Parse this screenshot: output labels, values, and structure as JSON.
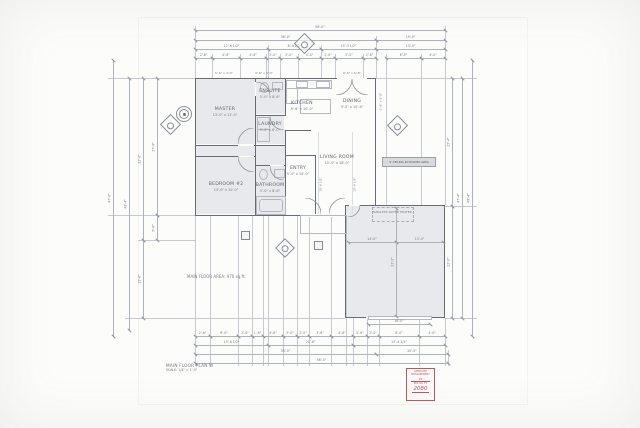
{
  "sheet": {
    "title_block": {
      "title": "MAIN FLOOR PLAN W",
      "scale": "SCALE: 1/4\" = 1'-0\""
    },
    "area_note": "MAIN FLOOR AREA: 970 sq.ft.",
    "ceiling_note": "9' CEILING IN SHADED AREA",
    "stamp": {
      "line1": "APPROVED MEASUREMENT",
      "line2": "26",
      "line3": "SEA SQ. FT.",
      "value": "2080",
      "color": "#b65a5e"
    },
    "paper_color": "#fcfcfb",
    "wall_color": "#666c76",
    "shade_color": "#e8e9ec"
  },
  "rooms": [
    {
      "label": "MASTER",
      "size": "13'-0\" x 12'-0\"",
      "x": 225,
      "y": 112
    },
    {
      "label": "ENSUITE",
      "size": "5'-0\" x 8'-6\"",
      "x": 270,
      "y": 94
    },
    {
      "label": "LAUNDRY",
      "size": "5'-0\" x 6'-0\"",
      "x": 270,
      "y": 127
    },
    {
      "label": "KITCHEN",
      "size": "9'-6\" x 10'-0\"",
      "x": 302,
      "y": 106
    },
    {
      "label": "DINING",
      "size": "9'-0\" x 10'-6\"",
      "x": 352,
      "y": 104
    },
    {
      "label": "LIVING ROOM",
      "size": "15'-0\" x 18'-0\"",
      "x": 337,
      "y": 160
    },
    {
      "label": "BEDROOM #2",
      "size": "13'-0\" x 10'-0\"",
      "x": 226,
      "y": 187
    },
    {
      "label": "BATHROOM",
      "size": "5'-0\" x 8'-6\"",
      "x": 270,
      "y": 188
    },
    {
      "label": "ENTRY",
      "size": "5'-0\" x 14'-0\"",
      "x": 298,
      "y": 171
    }
  ],
  "annotations": [
    {
      "text": "5'-6\" x 4'-0\"",
      "x": 224,
      "y": 72
    },
    {
      "text": "4'-6\" x 4'-0\"",
      "x": 264,
      "y": 72
    },
    {
      "text": "9'-0\" x 6'-8\"",
      "x": 352,
      "y": 72
    },
    {
      "text": "2'-8\" x 6'-8\"",
      "x": 381,
      "y": 100,
      "rot": -90
    },
    {
      "text": "10'-6 1/2\"",
      "x": 321,
      "y": 183,
      "rot": -90
    },
    {
      "text": "10'-6 1/2\"",
      "x": 355,
      "y": 183,
      "rot": -90
    },
    {
      "text": "TANKLESS WATER HEATER",
      "x": 392,
      "y": 211
    }
  ],
  "dimensions": {
    "horizontal": [
      {
        "y": 30,
        "segs": [
          [
            195,
            445,
            "56'-0\""
          ]
        ]
      },
      {
        "y": 40,
        "segs": [
          [
            195,
            376,
            "36'-0\""
          ],
          [
            376,
            445,
            "19'-0\""
          ]
        ]
      },
      {
        "y": 49,
        "segs": [
          [
            195,
            268,
            "12'-6 1/2\""
          ],
          [
            268,
            321,
            "8'-9 1/2\""
          ],
          [
            321,
            376,
            "15'-3 1/2\""
          ],
          [
            376,
            445,
            "13'-0\""
          ]
        ]
      },
      {
        "y": 58,
        "segs": [
          [
            195,
            212,
            "2'-6\""
          ],
          [
            212,
            240,
            "4'-6\""
          ],
          [
            240,
            266,
            "4'-6\""
          ],
          [
            266,
            280,
            "2'-0\""
          ],
          [
            280,
            298,
            "3'-0\""
          ],
          [
            298,
            321,
            "4'-0\""
          ],
          [
            321,
            335,
            "2'-0\""
          ],
          [
            335,
            363,
            "5'-0\""
          ],
          [
            363,
            376,
            "2'-6\""
          ],
          [
            386,
            421,
            "6'-0\""
          ],
          [
            421,
            445,
            "4'-0\""
          ]
        ]
      },
      {
        "y": 242,
        "segs": [
          [
            348,
            396,
            "14'-0\""
          ],
          [
            396,
            443,
            "13'-0\""
          ]
        ]
      },
      {
        "y": 324,
        "segs": [
          [
            368,
            430,
            "16'-0\""
          ]
        ]
      },
      {
        "y": 336,
        "segs": [
          [
            195,
            210,
            "2'-6\""
          ],
          [
            210,
            238,
            "6'-0\""
          ],
          [
            238,
            252,
            "2'-6\""
          ],
          [
            252,
            263,
            "1'-6\""
          ],
          [
            263,
            283,
            "4'-6\""
          ],
          [
            283,
            297,
            "3'-0\""
          ],
          [
            297,
            309,
            "2'-0\""
          ],
          [
            309,
            331,
            "3'-6\""
          ],
          [
            331,
            353,
            "4'-6\""
          ],
          [
            353,
            367,
            "2'-6\""
          ],
          [
            367,
            379,
            "2'-0\""
          ],
          [
            379,
            419,
            "8'-0\""
          ],
          [
            419,
            445,
            "4'-0\""
          ]
        ]
      },
      {
        "y": 345,
        "segs": [
          [
            195,
            268,
            "13'-6 1/2\""
          ],
          [
            268,
            353,
            "21'-6\""
          ],
          [
            353,
            445,
            "13'-4 1/2\""
          ]
        ]
      },
      {
        "y": 354,
        "segs": [
          [
            195,
            376,
            "36'-0\""
          ],
          [
            376,
            448,
            "20'-0\""
          ]
        ]
      },
      {
        "y": 363,
        "segs": [
          [
            195,
            448,
            "56'-0\""
          ]
        ]
      }
    ],
    "vertical": [
      {
        "x": 157,
        "segs": [
          [
            78,
            215,
            "27'-0\""
          ],
          [
            215,
            240,
            "5'-0\""
          ]
        ]
      },
      {
        "x": 143,
        "segs": [
          [
            78,
            240,
            "32'-0\""
          ],
          [
            240,
            318,
            "15'-6\""
          ]
        ]
      },
      {
        "x": 129,
        "segs": [
          [
            78,
            330,
            "43'-4\""
          ]
        ]
      },
      {
        "x": 113,
        "segs": [
          [
            60,
            336,
            "47'-0\""
          ]
        ]
      },
      {
        "x": 452,
        "segs": [
          [
            78,
            206,
            "25'-4\""
          ],
          [
            206,
            318,
            "22'-0\""
          ]
        ]
      },
      {
        "x": 462,
        "segs": [
          [
            78,
            318,
            "47'-4\""
          ]
        ]
      },
      {
        "x": 472,
        "segs": [
          [
            60,
            336,
            "49'-4\""
          ]
        ]
      },
      {
        "x": 396,
        "segs": [
          [
            208,
            316,
            "21'-2\""
          ]
        ]
      }
    ]
  },
  "geometry": {
    "shades": [
      [
        196,
        79,
        59,
        65
      ],
      [
        196,
        157,
        59,
        57
      ],
      [
        346,
        206,
        98,
        111
      ],
      [
        256,
        79,
        28.5,
        35
      ],
      [
        256,
        116,
        28.5,
        28
      ],
      [
        256,
        166,
        28.5,
        48
      ],
      [
        196,
        146,
        59,
        10
      ],
      [
        256,
        146,
        28.5,
        19
      ]
    ],
    "walls": [
      [
        195,
        78,
        181,
        1.4
      ],
      [
        195,
        78,
        1.4,
        138
      ],
      [
        195,
        214.6,
        151,
        1.4
      ],
      [
        374.6,
        78,
        1.4,
        128
      ],
      [
        345,
        205,
        100,
        1.2
      ],
      [
        443.8,
        205,
        1.2,
        113
      ],
      [
        345,
        316.8,
        100,
        1.2
      ],
      [
        345,
        205,
        1.2,
        113
      ],
      [
        255,
        78,
        1.1,
        137
      ],
      [
        284.5,
        78,
        1.1,
        137
      ],
      [
        255,
        114.5,
        30,
        1
      ],
      [
        255,
        144.5,
        30,
        1
      ],
      [
        255,
        165,
        30,
        1
      ],
      [
        196,
        144.5,
        59,
        1
      ],
      [
        196,
        156,
        59,
        1
      ],
      [
        285,
        154.5,
        30,
        1
      ],
      [
        314.5,
        155,
        1,
        60
      ],
      [
        285,
        129.5,
        26,
        1
      ]
    ],
    "gaps": [
      [
        337,
        77.5,
        30,
        2.4
      ],
      [
        306,
        214.4,
        38,
        2.4
      ],
      [
        349,
        204.7,
        11,
        1.8
      ],
      [
        366,
        316.6,
        66,
        2
      ],
      [
        238,
        144.2,
        16,
        1.6
      ],
      [
        238,
        155.7,
        16,
        1.6
      ],
      [
        270,
        164.7,
        14,
        1.6
      ],
      [
        254.6,
        82,
        1.8,
        14
      ],
      [
        284.2,
        116,
        1.8,
        14
      ]
    ],
    "fixtures": [
      [
        286,
        80,
        44,
        7,
        "s"
      ],
      [
        296,
        81,
        10,
        5,
        "s"
      ],
      [
        316,
        81,
        12,
        5,
        "s"
      ],
      [
        286,
        88,
        10,
        14,
        "s"
      ],
      [
        300,
        99,
        29,
        13,
        "s"
      ],
      [
        257,
        117,
        11,
        11,
        "s"
      ],
      [
        257,
        129,
        11,
        11,
        "s"
      ],
      [
        256,
        196,
        28,
        17,
        "s"
      ],
      [
        259,
        199,
        22,
        11,
        "r"
      ],
      [
        260,
        82,
        7,
        9,
        "e"
      ],
      [
        272,
        82,
        9,
        6,
        "s"
      ],
      [
        259,
        169,
        7,
        9,
        "e"
      ],
      [
        274,
        169,
        9,
        7,
        "s"
      ],
      [
        372,
        207,
        40,
        13,
        "d"
      ],
      [
        300,
        215,
        45,
        17,
        "s"
      ],
      [
        368,
        316.4,
        62,
        1.8,
        "s"
      ]
    ],
    "arcs": [
      {
        "x": 336,
        "y": 79,
        "r": 16,
        "h": "tl"
      },
      {
        "x": 352,
        "y": 79,
        "r": 16,
        "h": "tr"
      },
      {
        "x": 305,
        "y": 198,
        "r": 16,
        "h": "bl"
      },
      {
        "x": 329,
        "y": 198,
        "r": 16,
        "h": "br"
      },
      {
        "x": 238,
        "y": 128,
        "r": 16,
        "h": "br"
      },
      {
        "x": 238,
        "y": 156,
        "r": 16,
        "h": "tr"
      },
      {
        "x": 270,
        "y": 166,
        "r": 14,
        "h": "tr"
      },
      {
        "x": 256,
        "y": 82,
        "r": 14,
        "h": "bl"
      },
      {
        "x": 270,
        "y": 116,
        "r": 14,
        "h": "tr"
      },
      {
        "x": 348,
        "y": 205,
        "r": 12,
        "h": "tl"
      }
    ],
    "guides": {
      "v": [
        [
          195,
          26,
          78
        ],
        [
          212,
          54,
          78
        ],
        [
          240,
          54,
          78
        ],
        [
          266,
          54,
          78
        ],
        [
          280,
          54,
          78
        ],
        [
          298,
          54,
          78
        ],
        [
          321,
          45,
          78
        ],
        [
          335,
          54,
          78
        ],
        [
          363,
          54,
          78
        ],
        [
          268,
          45,
          78
        ],
        [
          376,
          36,
          78
        ],
        [
          386,
          54,
          205
        ],
        [
          421,
          54,
          205
        ],
        [
          445,
          26,
          205
        ],
        [
          195,
          216,
          366
        ],
        [
          210,
          216,
          366
        ],
        [
          238,
          216,
          366
        ],
        [
          252,
          216,
          366
        ],
        [
          263,
          216,
          366
        ],
        [
          268,
          216,
          366
        ],
        [
          283,
          216,
          366
        ],
        [
          297,
          216,
          366
        ],
        [
          309,
          216,
          366
        ],
        [
          331,
          216,
          366
        ],
        [
          346,
          216,
          366
        ],
        [
          353,
          318,
          366
        ],
        [
          367,
          318,
          366
        ],
        [
          379,
          318,
          366
        ],
        [
          419,
          318,
          366
        ],
        [
          445,
          318,
          366
        ],
        [
          448,
          350,
          366
        ]
      ],
      "h": [
        [
          78,
          108,
          195
        ],
        [
          215,
          108,
          195
        ],
        [
          240,
          138,
          195
        ],
        [
          318,
          125,
          345
        ],
        [
          78,
          376,
          477
        ],
        [
          206,
          445,
          477
        ],
        [
          318,
          445,
          477
        ]
      ],
      "vi": [
        [
          318,
          132,
          214
        ],
        [
          352,
          132,
          214
        ]
      ]
    },
    "markers": {
      "diamonds": [
        [
          303,
          42,
          13
        ],
        [
          169,
          123,
          13
        ],
        [
          396,
          124,
          13
        ],
        [
          284,
          247,
          12
        ]
      ],
      "squares": [
        [
          244,
          234,
          7
        ],
        [
          317,
          244,
          7
        ]
      ],
      "target": [
        183,
        113,
        14
      ]
    }
  }
}
